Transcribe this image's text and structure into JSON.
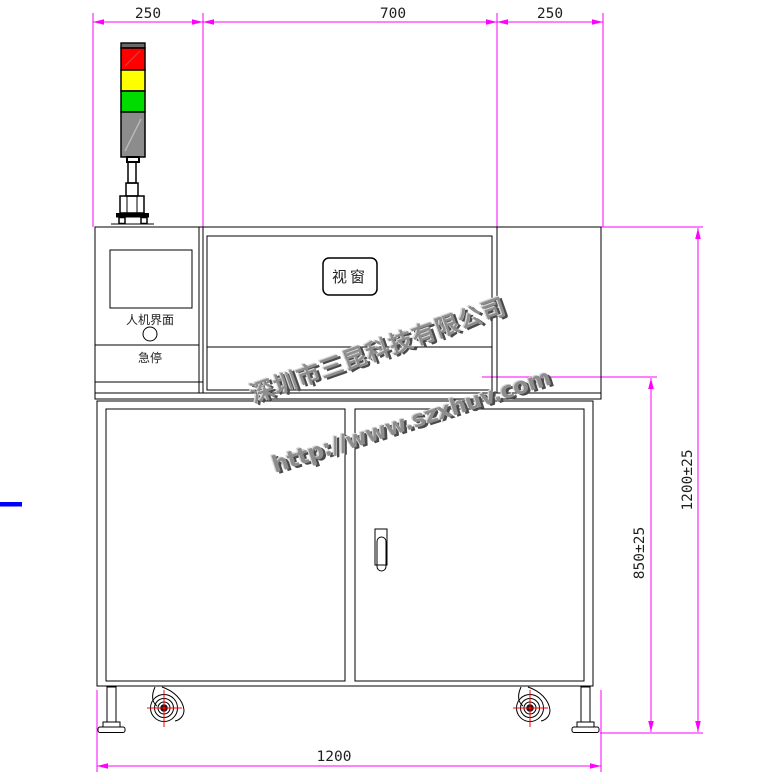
{
  "drawing": {
    "labels": {
      "window": "视窗",
      "hmi": "人机界面",
      "estop": "急停"
    },
    "dimensions": {
      "top_left": "250",
      "top_middle": "700",
      "top_right": "250",
      "overall_height": "1200±25",
      "table_height": "850±25",
      "overall_width": "1200"
    },
    "watermark": {
      "company": "深圳市三昆科技有限公司",
      "website": "http://www.szxhuv.com"
    },
    "colors": {
      "dimension_magenta": "#FF00FF",
      "outline_black": "#000000",
      "lamp_red": "#FF0000",
      "lamp_yellow": "#FFFF00",
      "lamp_green": "#00DC00",
      "lamp_gray": "#8C8C8C",
      "lamp_cap_gray": "#696969",
      "caster_crosshair_red": "#FF0000",
      "left_margin_blue": "#0000FF",
      "dim_text": "#1F1F1F",
      "watermark_gray": "#8D8D8D"
    }
  }
}
